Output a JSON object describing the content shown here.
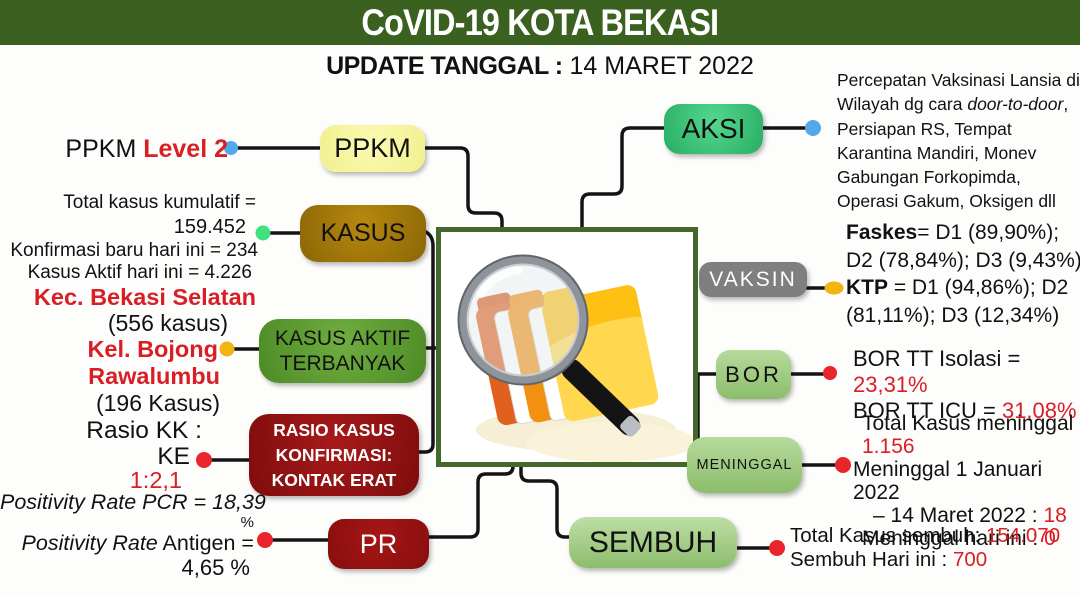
{
  "header": {
    "title": "CoVID-19 KOTA BEKASI",
    "update_label": "UPDATE TANGGAL :",
    "update_date": " 14 MARET 2022"
  },
  "nodes": {
    "ppkm": "PPKM",
    "kasus": "KASUS",
    "kasus_aktif": "KASUS AKTIF\nTERBANYAK",
    "rasio": "RASIO KASUS\nKONFIRMASI:\nKONTAK ERAT",
    "pr": "PR",
    "aksi": "AKSI",
    "vaksin": "VAKSIN",
    "bor": "BOR",
    "meninggal": "MENINGGAL",
    "sembuh": "SEMBUH"
  },
  "left": {
    "ppkm_prefix": "PPKM ",
    "ppkm_level": "Level 2",
    "kasus_total_label": "Total kasus kumulatif =",
    "kasus_total_value": "159.452",
    "kasus_new": "Konfirmasi baru hari ini = 234",
    "kasus_active": "Kasus Aktif hari ini = 4.226",
    "kec_name": "Kec. Bekasi Selatan",
    "kec_count": "(556 kasus)",
    "kel_name_1": "Kel. Bojong",
    "kel_name_2": "Rawalumbu",
    "kel_count": "(196 Kasus)",
    "rasio_label_1": "Rasio KK :",
    "rasio_label_2": "KE",
    "rasio_value": "1:2,1",
    "pcr_line": "Positivity Rate PCR =  18,39",
    "pcr_pct": "%",
    "antigen_italic": "Positivity Rate",
    "antigen_rest": " Antigen =",
    "antigen_value": "4,65 %"
  },
  "right": {
    "aksi_text_1": "Percepatan Vaksinasi Lansia di Wilayah dg cara ",
    "aksi_italic": "door-to-door",
    "aksi_text_2": ", Persiapan RS, Tempat Karantina Mandiri, Monev Gabungan Forkopimda, Operasi Gakum, Oksigen dll",
    "faskes_label": "Faskes",
    "faskes_values": "= D1 (89,90%); D2 (78,84%); D3 (9,43%)",
    "ktp_label": "KTP",
    "ktp_values": " = D1 (94,86%); D2 (81,11%); D3 (12,34%)",
    "bor_isolasi_label": "BOR TT Isolasi =",
    "bor_isolasi_value": "23,31%",
    "bor_icu_label": "BOR TT ICU = ",
    "bor_icu_value": "31,08%",
    "meninggal_total_label": "Total Kasus meninggal",
    "meninggal_total_value": "1.156",
    "meninggal_range_1": "Meninggal 1 Januari 2022",
    "meninggal_range_2": "– 14 Maret 2022 : ",
    "meninggal_range_value": "18",
    "meninggal_today_label": "Meninggal hari ini : ",
    "meninggal_today_value": "0",
    "sembuh_total_label": "Total Kasus sembuh: ",
    "sembuh_total_value": "154.070",
    "sembuh_today_label": "Sembuh Hari ini : ",
    "sembuh_today_value": "700"
  },
  "colors": {
    "header_green": "#3a6120",
    "frame_green": "#44682c",
    "ppkm_yellow": "#f9f8a0",
    "kasus_gold": "#a87d0e",
    "active_green": "#5f9c33",
    "dark_red": "#8e1111",
    "aksi_green": "#3ecb7d",
    "vaksin_gray": "#7f7f7f",
    "light_green": "#9dca7f",
    "red_text": "#d81f26",
    "dot_blue": "#52a9ea",
    "dot_green": "#3fe27e",
    "dot_yellow": "#f2b313",
    "dot_red": "#e8252b"
  }
}
